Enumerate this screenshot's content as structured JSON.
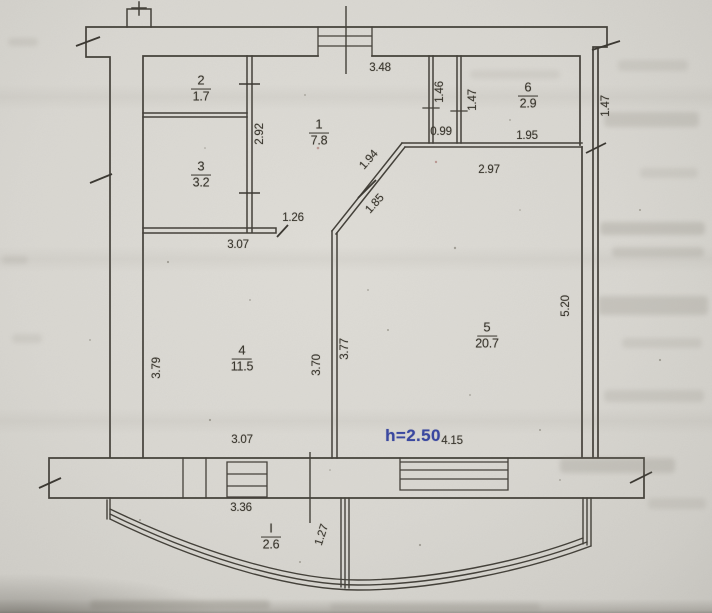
{
  "plan": {
    "colors": {
      "accent_blue": "#3a48a0",
      "ink": "#3a372f",
      "paper": "#d8d6d0"
    },
    "rooms": [
      {
        "number": "2",
        "area": "1.7",
        "x": 201,
        "y": 88
      },
      {
        "number": "3",
        "area": "3.2",
        "x": 201,
        "y": 174
      },
      {
        "number": "1",
        "area": "7.8",
        "x": 319,
        "y": 132
      },
      {
        "number": "6",
        "area": "2.9",
        "x": 528,
        "y": 95
      },
      {
        "number": "4",
        "area": "11.5",
        "x": 242,
        "y": 358
      },
      {
        "number": "5",
        "area": "20.7",
        "x": 487,
        "y": 335
      },
      {
        "number": "I",
        "area": "2.6",
        "x": 271,
        "y": 536
      }
    ],
    "dimensions": [
      {
        "text": "3.48",
        "x": 380,
        "y": 68,
        "rot": 0
      },
      {
        "text": "2.92",
        "x": 260,
        "y": 134,
        "rot": -90
      },
      {
        "text": "1.46",
        "x": 440,
        "y": 92,
        "rot": -90
      },
      {
        "text": "1.47",
        "x": 473,
        "y": 100,
        "rot": -90
      },
      {
        "text": "1.47",
        "x": 606,
        "y": 106,
        "rot": -90
      },
      {
        "text": "0.99",
        "x": 441,
        "y": 132,
        "rot": 0
      },
      {
        "text": "1.95",
        "x": 527,
        "y": 136,
        "rot": 0
      },
      {
        "text": "2.97",
        "x": 489,
        "y": 170,
        "rot": 0
      },
      {
        "text": "1.94",
        "x": 369,
        "y": 160,
        "rot": -48
      },
      {
        "text": "1.85",
        "x": 375,
        "y": 204,
        "rot": -48
      },
      {
        "text": "1.26",
        "x": 293,
        "y": 218,
        "rot": 0
      },
      {
        "text": "3.07",
        "x": 238,
        "y": 245,
        "rot": 0
      },
      {
        "text": "3.79",
        "x": 157,
        "y": 368,
        "rot": -90
      },
      {
        "text": "3.70",
        "x": 317,
        "y": 365,
        "rot": -90
      },
      {
        "text": "3.77",
        "x": 345,
        "y": 349,
        "rot": -90
      },
      {
        "text": "5.20",
        "x": 566,
        "y": 306,
        "rot": -90
      },
      {
        "text": "3.07",
        "x": 242,
        "y": 440,
        "rot": 0
      },
      {
        "text": "h=2.50",
        "x": 413,
        "y": 436,
        "rot": 0,
        "style": "height"
      },
      {
        "text": "4.15",
        "x": 452,
        "y": 441,
        "rot": 0
      },
      {
        "text": "3.36",
        "x": 241,
        "y": 508,
        "rot": 0
      },
      {
        "text": "1.27",
        "x": 322,
        "y": 535,
        "rot": -72
      }
    ]
  }
}
